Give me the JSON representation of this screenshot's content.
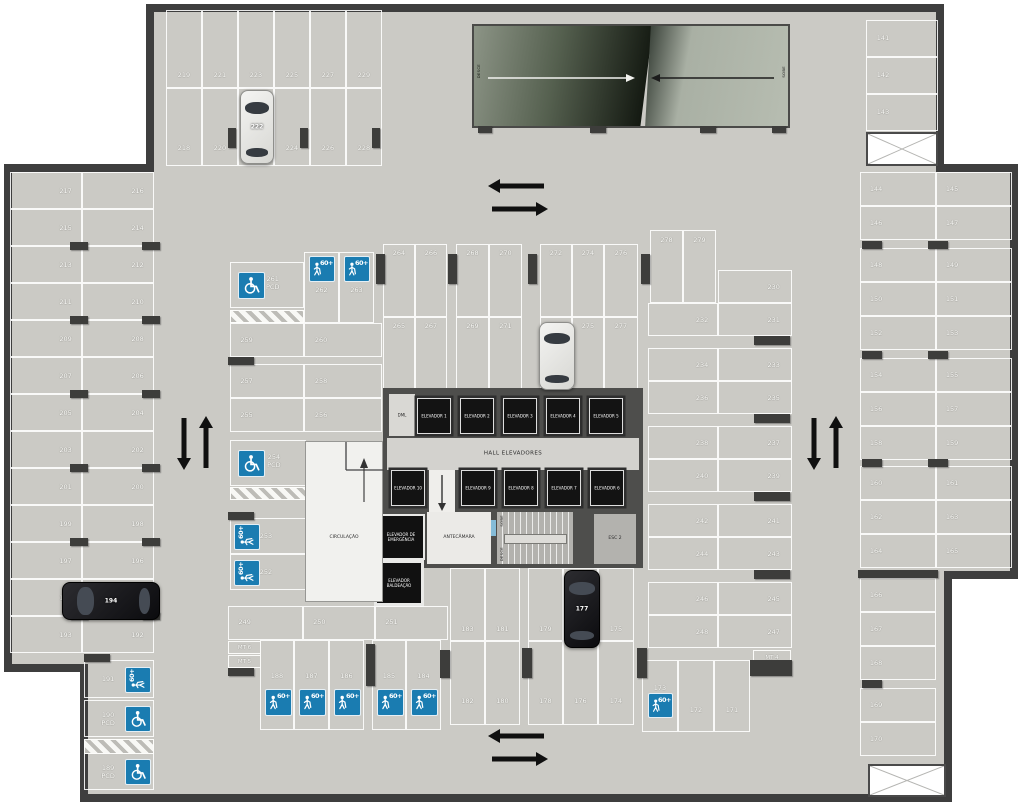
{
  "ramp": {
    "desce": "DESCE",
    "sobe": "SOBE"
  },
  "stairs": {
    "sobe": "SOBE",
    "desce": "DESCE"
  },
  "rooms": {
    "dml": "DML",
    "hall": "HALL ELEVADORES",
    "antecamara": "ANTECÂMARA",
    "esc2": "ESC 2",
    "circulacao": "CIRCULAÇÃO",
    "emergencia": [
      "ELEVADOR DE",
      "EMERGÊNCIA"
    ],
    "baldeacao": [
      "ELEVADOR",
      "BALDEAÇÃO"
    ],
    "elevators": [
      "ELEVADOR 1",
      "ELEVADOR 2",
      "ELEVADOR 3",
      "ELEVADOR 4",
      "ELEVADOR 5",
      "ELEVADOR 6",
      "ELEVADOR 7",
      "ELEVADOR 8",
      "ELEVADOR 9",
      "ELEVADOR 10"
    ]
  },
  "labels": {
    "pcd": "PCD",
    "sixty_plus": "60+",
    "mt4": "MT 4",
    "mt5": "MT 5",
    "mt6": "MT 6"
  },
  "colors": {
    "floor": "#cbcac5",
    "wall": "#3e3e3e",
    "sign_blue": "#1a7cb1",
    "elevator_black": "#131313",
    "ramp_dark": "#10150e",
    "ramp_light": "#b7bdb1",
    "car_white": "#e9e9e6",
    "car_black": "#141417"
  },
  "cars": [
    {
      "stall": "222",
      "color": "white"
    },
    {
      "stall": "273",
      "color": "white"
    },
    {
      "stall": "194",
      "color": "black"
    },
    {
      "stall": "177",
      "color": "black"
    }
  ],
  "stall_groups": {
    "top_row_upper": [
      "219",
      "221",
      "223",
      "225",
      "227",
      "229"
    ],
    "top_row_lower": [
      "218",
      "220",
      "222",
      "224",
      "226",
      "228"
    ],
    "left_col_outer": [
      "217",
      "215",
      "213",
      "211",
      "209",
      "207",
      "205",
      "203",
      "201",
      "199",
      "197",
      "195",
      "193"
    ],
    "left_col_inner": [
      "216",
      "214",
      "212",
      "210",
      "208",
      "206",
      "204",
      "202",
      "200",
      "198",
      "196",
      "194",
      "192"
    ],
    "left_sub": [
      "191",
      "190",
      "189"
    ],
    "mid_pcd": [
      "261",
      "254"
    ],
    "mid_h60": [
      "253",
      "252"
    ],
    "mid_v60": [
      "262",
      "263"
    ],
    "mid_rows": [
      "259",
      "260",
      "257",
      "258",
      "255",
      "256"
    ],
    "center_top": [
      "264",
      "266",
      "268",
      "270",
      "272",
      "274",
      "276"
    ],
    "center_bottom": [
      "265",
      "267",
      "269",
      "271",
      "273",
      "275",
      "277"
    ],
    "center_right_top": [
      "278",
      "279"
    ],
    "rc_left": [
      "232",
      "234",
      "236",
      "238",
      "240",
      "242",
      "244",
      "246",
      "248"
    ],
    "rc_right": [
      "230",
      "231",
      "233",
      "235",
      "237",
      "239",
      "241",
      "243",
      "245",
      "247"
    ],
    "rc_sub": [
      "173",
      "172",
      "171"
    ],
    "bottom_row": [
      "249",
      "250",
      "251"
    ],
    "bottom_60": [
      "188",
      "187",
      "186",
      "185",
      "184"
    ],
    "bcr_top": [
      "183",
      "181",
      "179",
      "177",
      "175"
    ],
    "bcr_bottom": [
      "182",
      "180",
      "178",
      "176",
      "174"
    ],
    "right_top": [
      "141",
      "142",
      "143"
    ],
    "right_left_col": [
      "144",
      "146",
      "148",
      "150",
      "152",
      "154",
      "156",
      "158",
      "160",
      "162",
      "164"
    ],
    "right_right_col": [
      "145",
      "147",
      "149",
      "151",
      "153",
      "155",
      "157",
      "159",
      "161",
      "163",
      "165"
    ],
    "right_single": [
      "166",
      "167",
      "168",
      "169",
      "170"
    ]
  }
}
